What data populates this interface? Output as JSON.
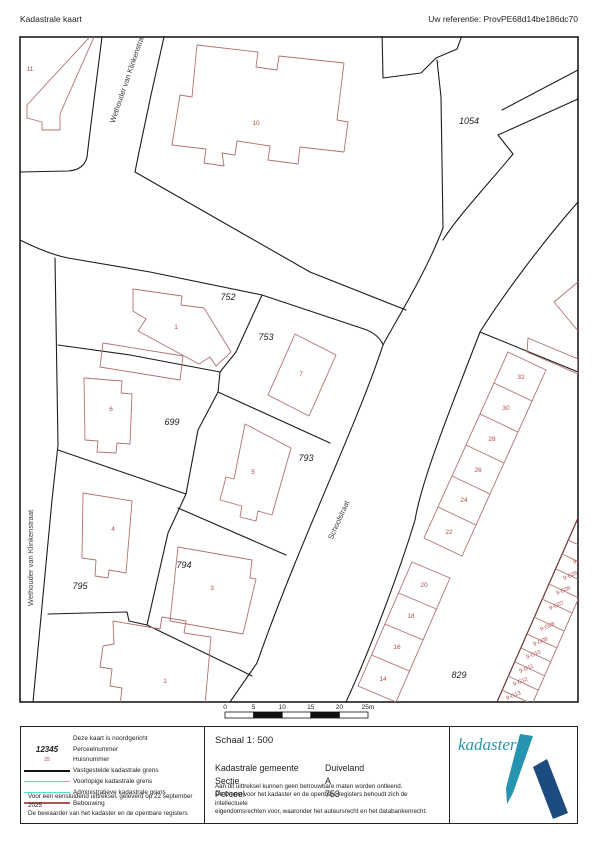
{
  "header": {
    "title": "Kadastrale kaart",
    "reference": "Uw referentie: ProvPE68d14be186dc70"
  },
  "map": {
    "frame": {
      "x": 20,
      "y": 37,
      "w": 558,
      "h": 665
    },
    "colors": {
      "black": "#1c1c1c",
      "red": "#b17272",
      "red_dark": "#6f3535",
      "house": "#b34a4a",
      "street_text": "#3a3a3a",
      "parcel_text": "#222222"
    },
    "black_lines": [
      "M102,37 L95,92 89,140 87,157 Q84,170 68,171 L20,172",
      "M164,37 L151,95 139,152 135,172",
      "M135,172 L240,232 310,272 406,310",
      "M20,240 Q48,254 68,258 L150,272 262,295 367,330 Q380,336 383,345",
      "M55,258 L58,445 52,500 33,702",
      "M443,228 C425,275 395,322 383,345 C355,430 300,540 257,663 L230,702",
      "M578,202 C540,245 500,300 480,332 C452,405 422,478 415,520 C400,570 370,650 346,702",
      "M513,154 C490,182 458,216 443,240",
      "M382,30 L383,78 421,73 436,58 457,49 464,30",
      "M437,60 L441,97 443,228",
      "M578,70 L502,110",
      "M578,99 L498,135 513,154",
      "M480,332 L578,372",
      "M262,295 L236,352 220,372",
      "M58,345 L130,355 220,372",
      "M220,372 L218,392",
      "M218,392 L330,443",
      "M218,392 L198,430 186,494 168,533 147,625",
      "M58,450 L186,494",
      "M178,508 L286,555",
      "M147,625 L240,670 252,676",
      "M48,614 L127,612 129,621 147,625"
    ],
    "red_lines": [
      {
        "d": "M98,28 L27,105 27,118 42,122 42,130 60,130 60,114 98,28 Z"
      },
      {
        "d": "M197,45 L258,52 256,67 277,70 279,56 344,63 337,120 348,122 344,152 300,147 298,164 268,160 270,146 237,141 235,155 222,153 224,166 204,163 206,149 172,145 180,95 192,97 197,45 Z"
      },
      {
        "d": "M103,343 L183,356 180,380 100,367 Z"
      },
      {
        "d": "M133,289 L182,296 181,305 204,308 231,352 216,366 210,357 199,364 138,331 146,319 133,311 Z"
      },
      {
        "d": "M295,334 L336,355 309,416 268,395 Z"
      },
      {
        "d": "M84,378 L122,381 121,393 132,394 130,444 117,443 116,453 97,452 98,441 85,440 Z"
      },
      {
        "d": "M245,424 L291,448 272,515 258,511 256,521 240,517 242,506 220,500 226,477 234,479 Z"
      },
      {
        "d": "M83,493 L132,501 126,573 109,570 108,578 95,576 96,560 82,558 Z"
      },
      {
        "d": "M178,547 L252,560 250,578 256,579 243,634 170,621 Z"
      },
      {
        "d": "M113,621 L160,629 162,617 186,621 184,633 211,637 205,705 120,705 122,688 110,686 112,669 100,667 103,646 114,644 Z"
      },
      {
        "d": "M528,338 L578,359 578,374 527,352 Z"
      },
      {
        "d": "M578,282 L554,302 578,331"
      },
      {
        "d": "M508,352 L546,370 462,556 424,538 Z",
        "n": "terraced-row-outline"
      },
      {
        "d": "M494,383 L532,401",
        "n": "terraced-divider-line"
      },
      {
        "d": "M480,414 L518,432",
        "n": "terraced-divider-line"
      },
      {
        "d": "M466,445 L504,463",
        "n": "terraced-divider-line"
      },
      {
        "d": "M452,476 L490,494",
        "n": "terraced-divider-line"
      },
      {
        "d": "M438,507 L476,525",
        "n": "terraced-divider-line"
      },
      {
        "d": "M412,562 L450,578 396,702 358,686 Z",
        "n": "terraced-row-outline"
      },
      {
        "d": "M398.5,593 L436.5,609",
        "n": "terraced-divider-line"
      },
      {
        "d": "M385,624 L423,640",
        "n": "terraced-divider-line"
      },
      {
        "d": "M371.5,655 L409.5,671",
        "n": "terraced-divider-line"
      },
      {
        "d": "M578,518 L497,702",
        "c": "#6f3535",
        "w": 1.2,
        "n": "garage-row-line"
      },
      {
        "d": "M608,531 L527,716",
        "n": "garage-row-line"
      },
      {
        "d": "M568,540 L598,554",
        "n": "garage-divider-line"
      },
      {
        "d": "M562,554 L592,568",
        "n": "garage-divider-line"
      },
      {
        "d": "M556,569 L586,583",
        "n": "garage-divider-line"
      },
      {
        "d": "M549,584 L579,598",
        "n": "garage-divider-line"
      },
      {
        "d": "M542,599 L572,613",
        "n": "garage-divider-line"
      },
      {
        "d": "M534,617 L564,631",
        "n": "garage-divider-line"
      },
      {
        "d": "M527,634 L557,648",
        "n": "garage-divider-line"
      },
      {
        "d": "M521,648 L551,662",
        "n": "garage-divider-line"
      },
      {
        "d": "M515,662 L545,676",
        "n": "garage-divider-line"
      },
      {
        "d": "M508,676 L538,690",
        "n": "garage-divider-line"
      },
      {
        "d": "M502,690 L532,704",
        "n": "garage-divider-line"
      }
    ],
    "parcel_labels": [
      {
        "t": "752",
        "x": 228,
        "y": 300
      },
      {
        "t": "753",
        "x": 266,
        "y": 340
      },
      {
        "t": "699",
        "x": 172,
        "y": 425
      },
      {
        "t": "793",
        "x": 306,
        "y": 461
      },
      {
        "t": "794",
        "x": 184,
        "y": 568
      },
      {
        "t": "795",
        "x": 80,
        "y": 589
      },
      {
        "t": "829",
        "x": 459,
        "y": 678
      },
      {
        "t": "1054",
        "x": 469,
        "y": 124
      }
    ],
    "house_labels": [
      {
        "t": "11",
        "x": 30,
        "y": 71
      },
      {
        "t": "10",
        "x": 256,
        "y": 125
      },
      {
        "t": "1",
        "x": 176,
        "y": 329
      },
      {
        "t": "7",
        "x": 301,
        "y": 376
      },
      {
        "t": "6",
        "x": 111,
        "y": 411
      },
      {
        "t": "5",
        "x": 253,
        "y": 474
      },
      {
        "t": "4",
        "x": 113,
        "y": 531
      },
      {
        "t": "3",
        "x": 212,
        "y": 590
      },
      {
        "t": "1",
        "x": 165,
        "y": 683
      },
      {
        "t": "32",
        "x": 521,
        "y": 379
      },
      {
        "t": "30",
        "x": 506,
        "y": 410
      },
      {
        "t": "28",
        "x": 492,
        "y": 441
      },
      {
        "t": "26",
        "x": 478,
        "y": 472
      },
      {
        "t": "24",
        "x": 464,
        "y": 502
      },
      {
        "t": "22",
        "x": 449,
        "y": 534
      },
      {
        "t": "20",
        "x": 424,
        "y": 587
      },
      {
        "t": "18",
        "x": 411,
        "y": 618
      },
      {
        "t": "16",
        "x": 397,
        "y": 649
      },
      {
        "t": "14",
        "x": 383,
        "y": 681
      }
    ],
    "garage_labels": [
      {
        "t": "9-G04",
        "x": 581,
        "y": 561,
        "r": -23
      },
      {
        "t": "9-G05",
        "x": 571,
        "y": 577,
        "r": -23
      },
      {
        "t": "9-G06",
        "x": 564,
        "y": 592,
        "r": -23
      },
      {
        "t": "9-G07",
        "x": 557,
        "y": 607,
        "r": -23
      },
      {
        "t": "9-G08",
        "x": 548,
        "y": 628,
        "r": -23
      },
      {
        "t": "9-G09",
        "x": 541,
        "y": 643,
        "r": -23
      },
      {
        "t": "9-G10",
        "x": 534,
        "y": 656,
        "r": -23
      },
      {
        "t": "9-G11",
        "x": 527,
        "y": 670,
        "r": -23
      },
      {
        "t": "9-G12",
        "x": 521,
        "y": 683,
        "r": -23
      },
      {
        "t": "9-G13",
        "x": 514,
        "y": 697,
        "r": -23
      }
    ],
    "street_labels": [
      {
        "t": "Wethouder van Klinkenstraat",
        "x": 130,
        "y": 78,
        "r": -71
      },
      {
        "t": "Wethouder van Klinkenstraat",
        "x": 33,
        "y": 558,
        "r": -90
      },
      {
        "t": "Schoolstraat",
        "x": 341,
        "y": 521,
        "r": -66
      }
    ]
  },
  "scalebar": {
    "x": 225,
    "y": 712,
    "seg_w": 28.6,
    "h": 6,
    "labels": [
      "0",
      "5",
      "10",
      "15",
      "20",
      "25m"
    ],
    "fills": [
      "#ffffff",
      "#111111",
      "#ffffff",
      "#111111",
      "#ffffff"
    ]
  },
  "legend": {
    "rows": [
      {
        "symbol": "none",
        "label": "Deze kaart is noordgericht"
      },
      {
        "symbol": "parcel",
        "symbol_text": "12345",
        "label": "Perceelnummer"
      },
      {
        "symbol": "house",
        "symbol_text": "25",
        "label": "Huisnummer"
      },
      {
        "symbol": "line",
        "color": "#111111",
        "label": "Vastgestelde kadastrale grens"
      },
      {
        "symbol": "line",
        "color": "#f0a32e",
        "label": "Voorlopige kadastrale grens"
      },
      {
        "symbol": "line",
        "color": "#57ded6",
        "label": "Administratieve kadastrale grens"
      },
      {
        "symbol": "line",
        "color": "#b05555",
        "label": "Bebouwing"
      }
    ],
    "footnote1": "Voor een eensluidend uittreksel, geleverd op 22 september 2025",
    "footnote2": "De bewaarder van het kadaster en de openbare registers"
  },
  "info": {
    "scale_label": "Schaal 1: 500",
    "rows": [
      {
        "label": "Kadastrale gemeente",
        "value": "Duiveland"
      },
      {
        "label": "Sectie",
        "value": "A"
      },
      {
        "label": "Perceel",
        "value": "753"
      }
    ],
    "disclaimer": [
      "Aan dit uittreksel kunnen geen betrouwbare maten worden ontleend.",
      "De Dienst voor het kadaster en de openbare registers behoudt zich de intellectuele",
      "eigendomsrechten voor, waaronder het auteursrecht en het databankenrecht."
    ]
  },
  "logo": {
    "text": "kadaster",
    "teal": "#2694b0",
    "navy": "#1b4b80"
  }
}
